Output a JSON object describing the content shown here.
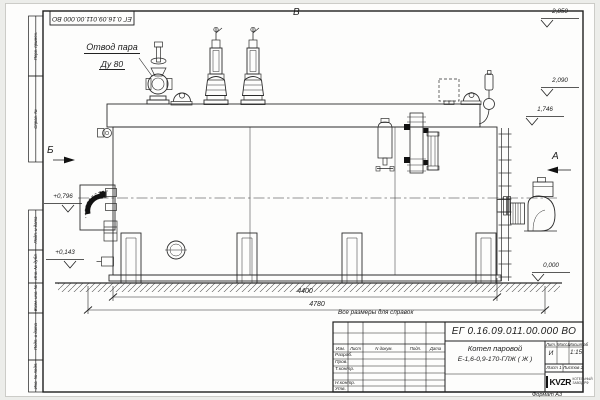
{
  "sheet": {
    "doc_number_inverted": "ЕГ 0.16.09.011.00.000 ВО",
    "format_label": "Формат А3",
    "reference_note": "Все размеры для справок",
    "watermark_text": "kvzr.ru"
  },
  "annotations": {
    "steam_outlet_line1": "Отвод пара",
    "steam_outlet_line2": "Ду 80",
    "view_top": "В",
    "view_left": "Б",
    "view_right": "А"
  },
  "elevations": {
    "right_top": "2,850",
    "right_mid": "2,090",
    "right_low": "1,746",
    "left_upper": "+0,796",
    "left_lower": "+0,143",
    "ground": "0,000"
  },
  "dimensions": {
    "boiler_length": "4400",
    "overall_length": "4780"
  },
  "title_block": {
    "designation": "ЕГ 0.16.09.011.00.000  ВО",
    "product_line1": "Котел паровой",
    "product_line2": "Е-1,6-0,9-170-ГЛЖ ( Ж )",
    "col_izm": "Изм.",
    "col_list": "Лист",
    "col_doc": "N докум.",
    "col_podp": "Подп.",
    "col_data": "Дата",
    "row_razrab": "Разраб.",
    "row_prov": "Пров.",
    "row_tkontr": "Т.контр.",
    "row_nkontr": "Н.контр.",
    "row_utv": "Утв.",
    "lit_header": "Лит.",
    "mass_header": "Масса",
    "scale_header": "Масштаб",
    "lit_value": "И",
    "scale_value": "1:15",
    "sheet_label": "Лист",
    "sheet_number": "1",
    "sheets_label": "Листов",
    "sheets_total": "2",
    "company_logo": "KVZR",
    "company_name_line1": "КОТЕЛЬНЫЙ",
    "company_name_line2": "ЗАВОД РФ"
  },
  "side_stamps": {
    "s1": "Перв. примен.",
    "s2": "Справ. №",
    "s3": "Подп. и дата",
    "s4": "Инв. № дубл.",
    "s5": "Взам. инв. №",
    "s6": "Подп. и дата",
    "s7": "Инв. № подл."
  }
}
